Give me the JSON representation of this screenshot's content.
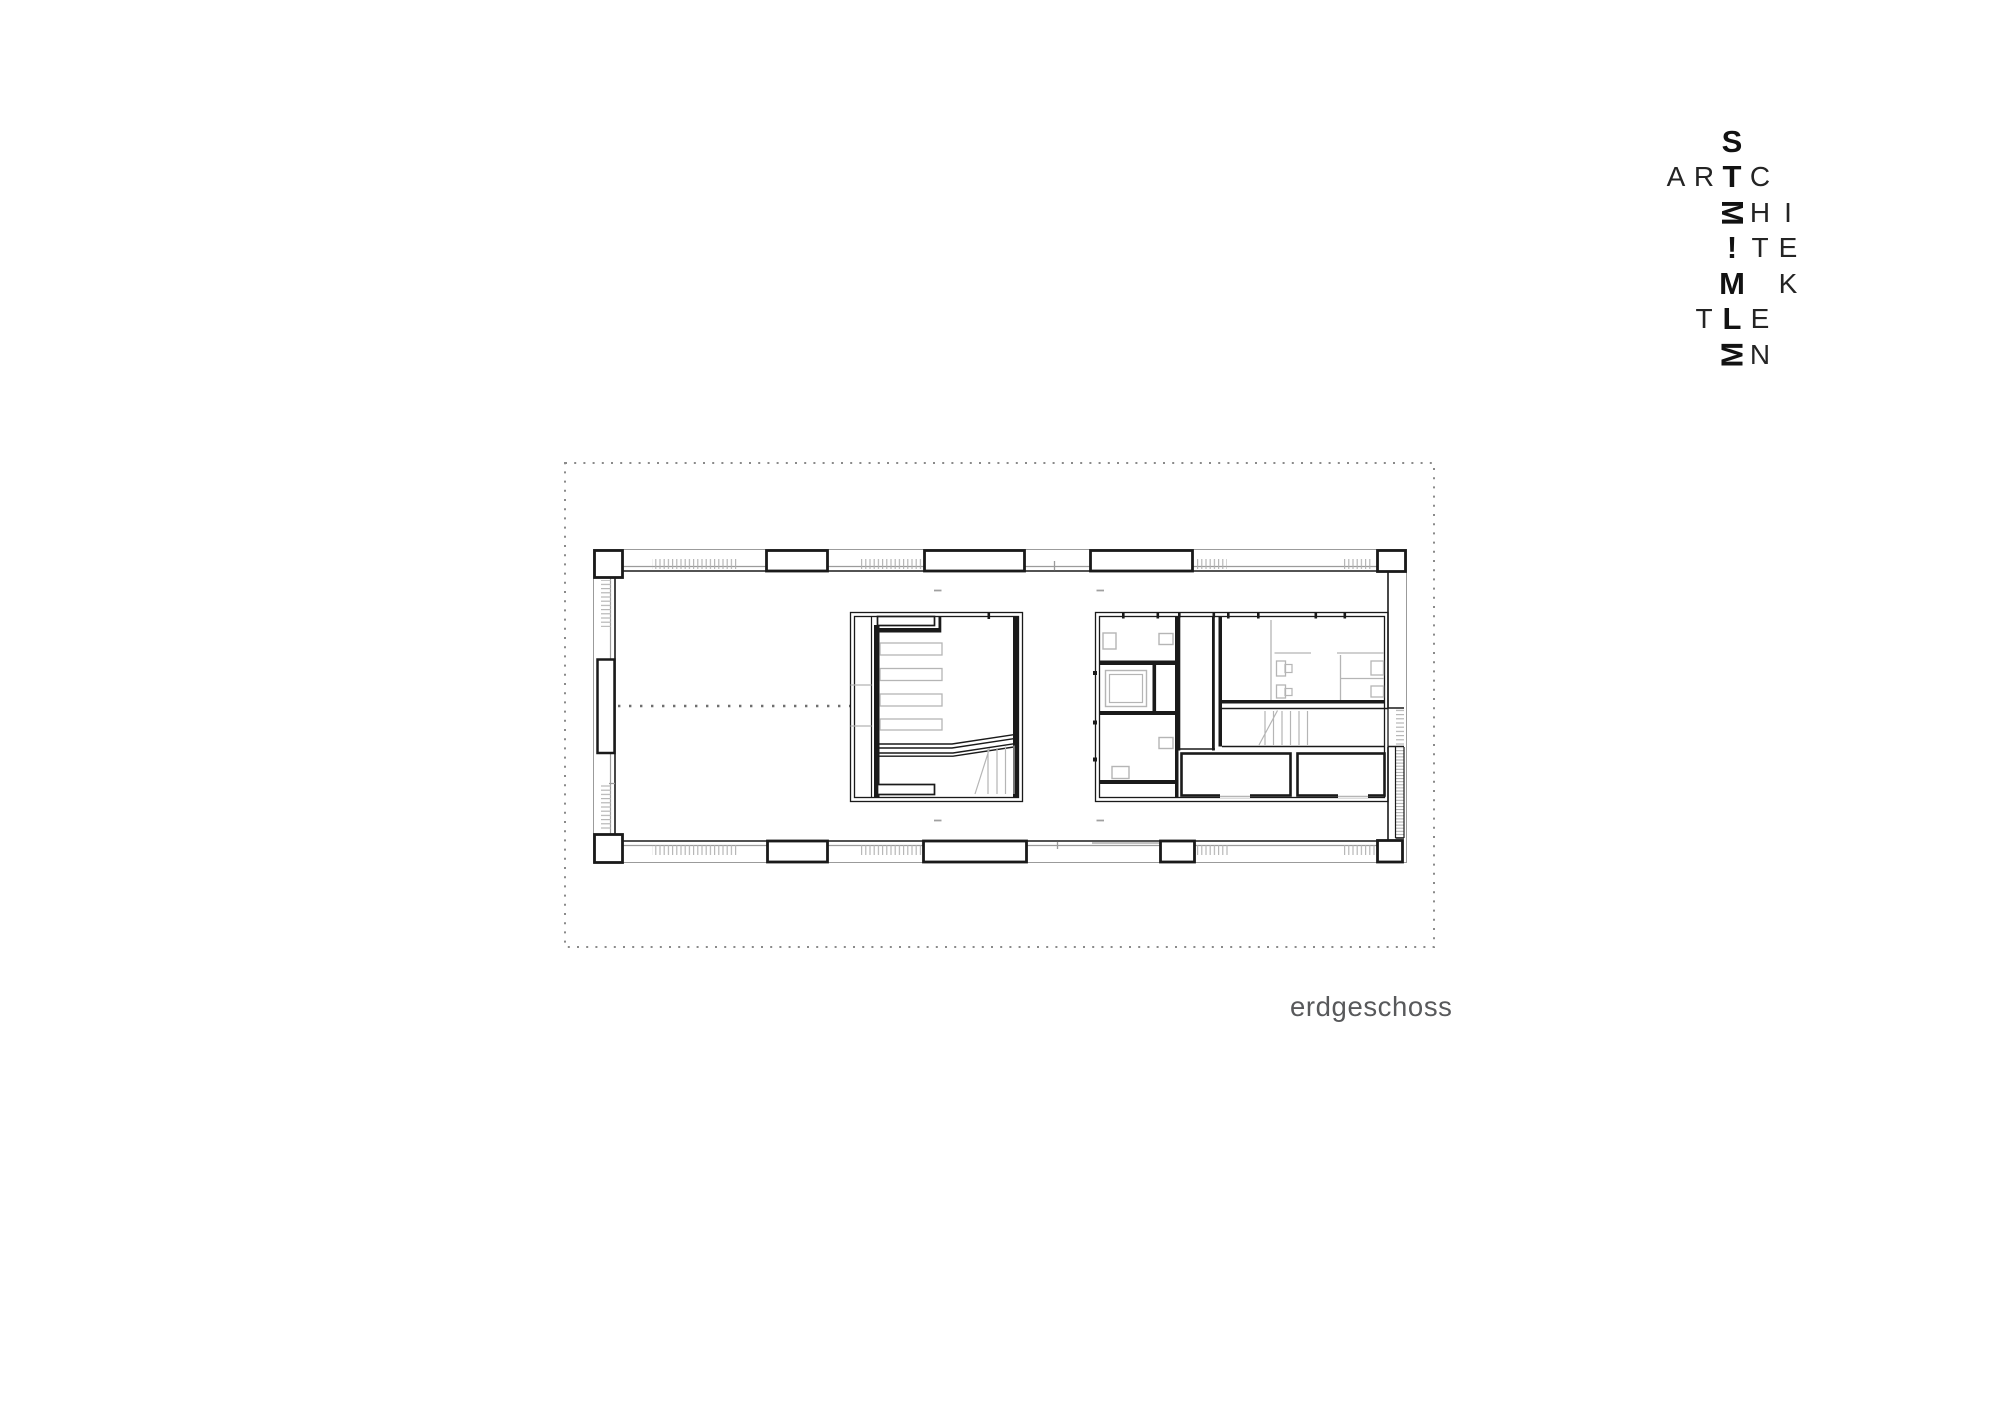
{
  "logo": {
    "name": "STEIMLE ARCHITEKTEN",
    "grid": {
      "left": 1662,
      "top": 124,
      "cell_w": 28,
      "cell_h": 35.5
    },
    "letters": [
      {
        "ch": "S",
        "row": 0,
        "col": 2,
        "weight": "bold"
      },
      {
        "ch": "A",
        "row": 1,
        "col": 0,
        "weight": "light"
      },
      {
        "ch": "R",
        "row": 1,
        "col": 1,
        "weight": "light"
      },
      {
        "ch": "T",
        "row": 1,
        "col": 2,
        "weight": "bold"
      },
      {
        "ch": "C",
        "row": 1,
        "col": 3,
        "weight": "light"
      },
      {
        "ch": "E",
        "row": 2,
        "col": 2,
        "weight": "bold",
        "display": "M",
        "rot": 90
      },
      {
        "ch": "H",
        "row": 2,
        "col": 3,
        "weight": "light"
      },
      {
        "ch": "I",
        "row": 2,
        "col": 4,
        "weight": "light"
      },
      {
        "ch": "I",
        "row": 3,
        "col": 2,
        "weight": "bold",
        "display": "!"
      },
      {
        "ch": "T",
        "row": 3,
        "col": 3,
        "weight": "light"
      },
      {
        "ch": "E",
        "row": 3,
        "col": 4,
        "weight": "light"
      },
      {
        "ch": "M",
        "row": 4,
        "col": 2,
        "weight": "bold"
      },
      {
        "ch": "K",
        "row": 4,
        "col": 4,
        "weight": "light"
      },
      {
        "ch": "T",
        "row": 5,
        "col": 1,
        "weight": "light"
      },
      {
        "ch": "L",
        "row": 5,
        "col": 2,
        "weight": "bold"
      },
      {
        "ch": "E",
        "row": 5,
        "col": 3,
        "weight": "light"
      },
      {
        "ch": "E",
        "row": 6,
        "col": 2,
        "weight": "bold",
        "display": "M",
        "rot": -90
      },
      {
        "ch": "N",
        "row": 6,
        "col": 3,
        "weight": "light"
      }
    ]
  },
  "plan": {
    "label": "erdgeschoss"
  },
  "colors": {
    "background": "#ffffff",
    "wall": "#1a1a1a",
    "mid_gray": "#9b9b9b",
    "light_gray": "#b5b5b5",
    "dots": "#8a8a8a",
    "label": "#58595b"
  }
}
